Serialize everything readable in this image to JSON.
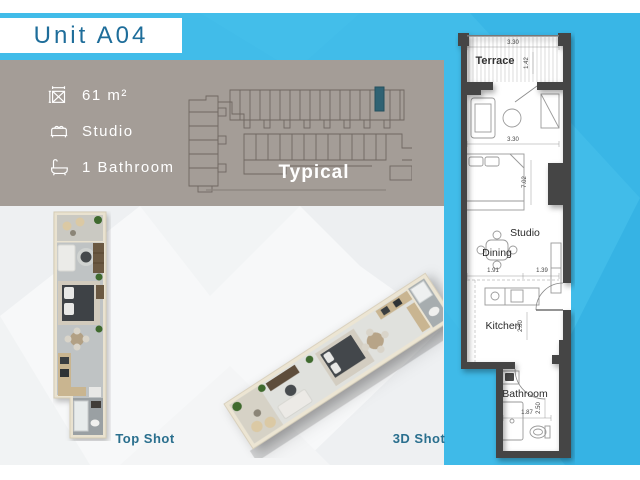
{
  "header": {
    "title": "Unit A04"
  },
  "info_panel": {
    "area": "61 m²",
    "unit_type": "Studio",
    "bathrooms": "1 Bathroom",
    "footprint_label": "Typical"
  },
  "views": {
    "top_shot_label": "Top Shot",
    "three_d_shot_label": "3D Shot"
  },
  "floor_plan": {
    "terrace": {
      "name": "Terrace",
      "width_dim": "3.30",
      "depth_dim": "1.42"
    },
    "studio": {
      "name": "Studio",
      "width_dim": "3.30",
      "length_dim": "7.02"
    },
    "dining": {
      "name": "Dining",
      "left_dim": "1.91",
      "right_dim": "1.39"
    },
    "kitchen": {
      "name": "Kitchen",
      "depth_dim": "2.80"
    },
    "bathroom": {
      "name": "Bathroom",
      "depth_dim": "2.50",
      "width_dim": "1.87"
    }
  },
  "colors": {
    "accent_cyan": "#41bce9",
    "panel_grey": "#a49d97",
    "title_blue": "#1e6d9a",
    "label_teal": "#2a6f8e",
    "highlight_unit": "#2f6273",
    "wall_grey": "#454545"
  }
}
